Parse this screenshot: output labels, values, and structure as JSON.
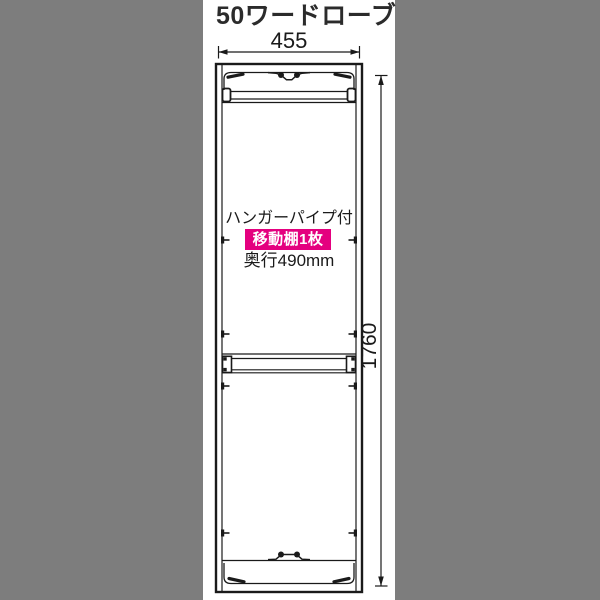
{
  "title": "50ワードローブ",
  "dimensions": {
    "width_mm": "455",
    "height_mm": "1760"
  },
  "annotations": {
    "hanger_pipe_label": "ハンガーパイプ付",
    "movable_shelf_badge": "移動棚1枚",
    "depth_label": "奥行490mm"
  },
  "icons": {
    "width_arrow": "left-right-dimension-arrow",
    "height_arrow": "up-down-dimension-arrow"
  },
  "colors": {
    "background": "#7d7d7d",
    "panel": "#ffffff",
    "line": "#1a1a1a",
    "badge_bg": "#e4007f",
    "badge_text": "#ffffff",
    "text": "#2b2b2b"
  }
}
